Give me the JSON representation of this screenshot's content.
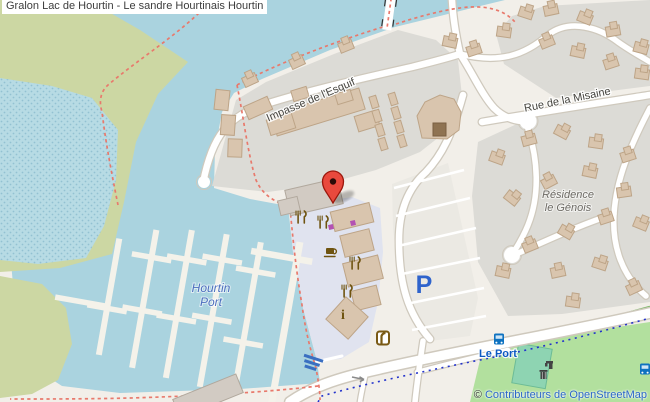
{
  "title_bar": {
    "text": "Gralon Lac de Hourtin - Le sandre Hourtinais Hourtin"
  },
  "map_labels": {
    "street_esquif": "Impasse de l'Esquif",
    "street_misaine": "Rue de la Misaine",
    "residence_line1": "Résidence",
    "residence_line2": "le Génois",
    "marina_line1": "Hourtin",
    "marina_line2": "Port",
    "bus_stop": "Le Port",
    "parking": "P",
    "info": "i"
  },
  "attribution": {
    "copyright": "©",
    "text": "Contributeurs de OpenStreetMap"
  },
  "icons": {
    "marker": "red-map-pin",
    "restaurant": "fork-and-knife",
    "restaurant_count": 4,
    "cafe": "coffee-cup",
    "information": "letter-i",
    "shop": "purple-square",
    "bus_stop": "blue-bus",
    "parking": "letter-P",
    "slipway": "boat-ramp-stripes",
    "drinking_water": "tap",
    "waste_basket": "bin",
    "oneway": "gray-arrow",
    "storefront": "brown-door"
  },
  "colors": {
    "water": "#aad3df",
    "land": "#f2efe9",
    "scrub": "#ccd7a3",
    "residential": "#dcdbd6",
    "plaza": "#e0e3ef",
    "park": "#b2e09e",
    "pitch": "#8ed4b2",
    "road": "#ffffff",
    "building": "#d9c5ae",
    "marker_red": "#e9493d",
    "poi_brown": "#6f5410",
    "shop_purple": "#b352b3",
    "transit_blue": "#0e72c0",
    "route_blue": "#2333cc",
    "path_red": "#e8796c",
    "link_blue": "#2a66c8"
  }
}
